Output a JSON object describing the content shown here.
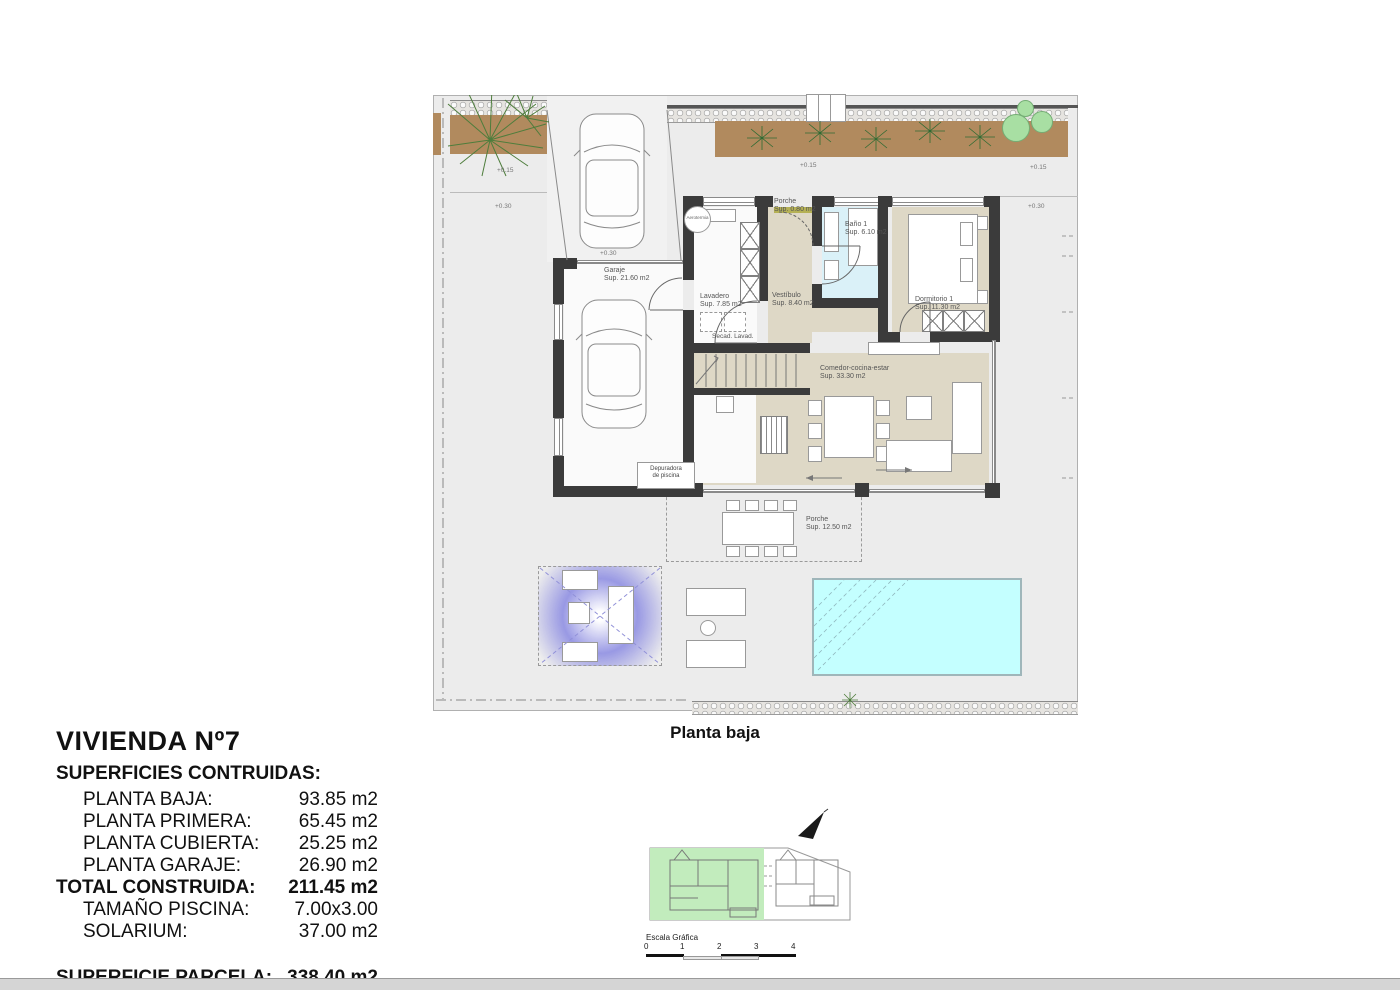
{
  "page": {
    "plan_title": "Planta baja"
  },
  "summary": {
    "title": "VIVIENDA Nº7",
    "subtitle": "SUPERFICIES CONTRUIDAS:",
    "rows": [
      {
        "label": "PLANTA BAJA:",
        "value": "93.85 m2"
      },
      {
        "label": "PLANTA PRIMERA:",
        "value": "65.45 m2"
      },
      {
        "label": "PLANTA CUBIERTA:",
        "value": "25.25 m2"
      },
      {
        "label": "PLANTA GARAJE:",
        "value": "26.90 m2"
      },
      {
        "label": "TOTAL CONSTRUIDA:",
        "value": "211.45 m2"
      },
      {
        "label": "TAMAÑO PISCINA:",
        "value": "7.00x3.00"
      },
      {
        "label": "SOLARIUM:",
        "value": "37.00 m2"
      },
      {
        "label": "SUPERFICIE PARCELA:",
        "value": "338.40 m2"
      }
    ]
  },
  "plan": {
    "rooms": [
      {
        "name": "Porche",
        "area": "Sup. 0.80 m2"
      },
      {
        "name": "Baño 1",
        "area": "Sup. 6.10 m2"
      },
      {
        "name": "Lavadero",
        "area": "Sup. 7.85 m2"
      },
      {
        "name": "Vestíbulo",
        "area": "Sup. 8.40 m2"
      },
      {
        "name": "Dormitorio 1",
        "area": "Sup. 11.30 m2"
      },
      {
        "name": "Garaje",
        "area": "Sup. 21.60 m2"
      },
      {
        "name": "Comedor-cocina-estar",
        "area": "Sup. 33.30 m2"
      },
      {
        "name": "Porche",
        "area": "Sup. 12.50 m2"
      }
    ],
    "equipment": {
      "aerotermia": "Aerotermia",
      "secadora": "Secad.",
      "lavadora": "Lavad.",
      "depuradora_line1": "Depuradora",
      "depuradora_line2": "de piscina"
    },
    "levels": {
      "plus015": "+0.15",
      "plus030": "+0.30"
    }
  },
  "keyplan": {
    "scale_label": "Escala Gráfica",
    "ticks": [
      "0",
      "1",
      "2",
      "3",
      "4"
    ]
  },
  "colors": {
    "wall": "#3b3b3b",
    "floor_beige": "#ded8c6",
    "bath_blue": "#daf1f8",
    "pool_cyan": "#c4ffff",
    "planting_brown": "#b18a5e",
    "bush_green": "#a8dfa3",
    "keyplan_green": "#c2ecbd",
    "pergola_purple": "#8c8cdc",
    "entry_mat_olive": "#b5b155"
  }
}
